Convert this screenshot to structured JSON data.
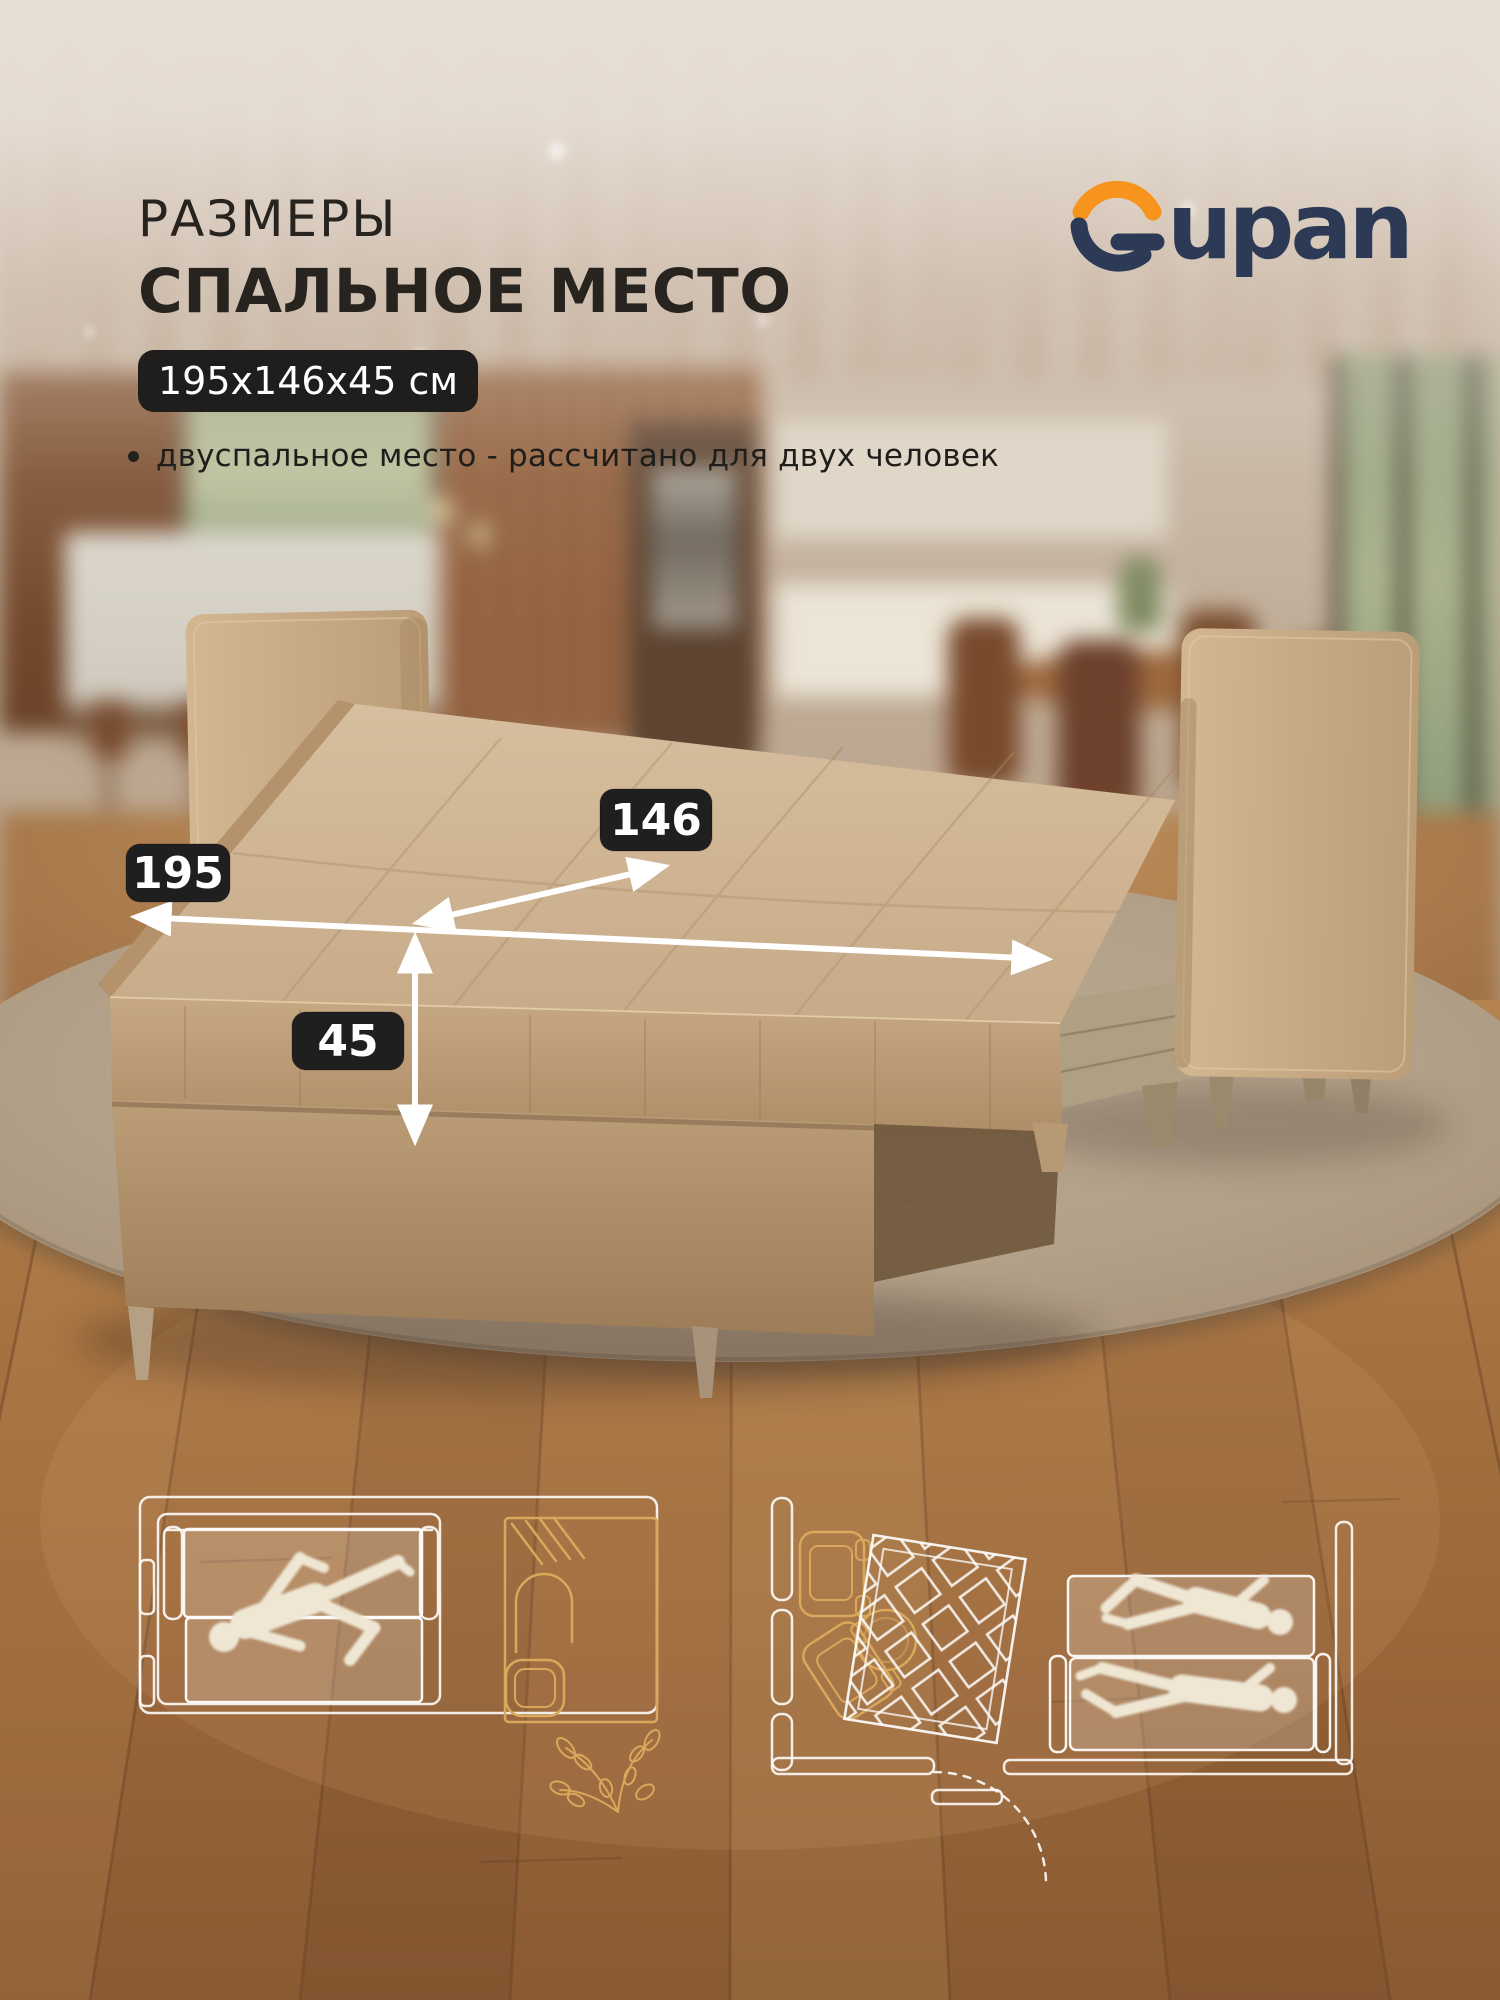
{
  "header": {
    "title_line1": "РАЗМЕРЫ",
    "title_line2": "СПАЛЬНОЕ МЕСТО",
    "dimensions_badge": "195x146x45 см",
    "bullet_text": "двуспальное место - рассчитано для двух человек"
  },
  "brand": {
    "name": "Gupan",
    "wordmark_tail": "upan",
    "orange": "#F7941D",
    "navy": "#2D3A56"
  },
  "dimensions": {
    "length_cm": "195",
    "width_cm": "146",
    "height_cm": "45"
  },
  "style": {
    "badge_bg": "#1F1E1D",
    "arrow_color": "#FFFFFF",
    "fabric": "#C8AC88",
    "rug": "#B2A189",
    "floor_light": "#AB774B",
    "floor_dark": "#7C4B2A",
    "lineart_white": "#FFFFFF",
    "lineart_gold": "#D9A85C",
    "silhouette": "#EFE7D4"
  }
}
